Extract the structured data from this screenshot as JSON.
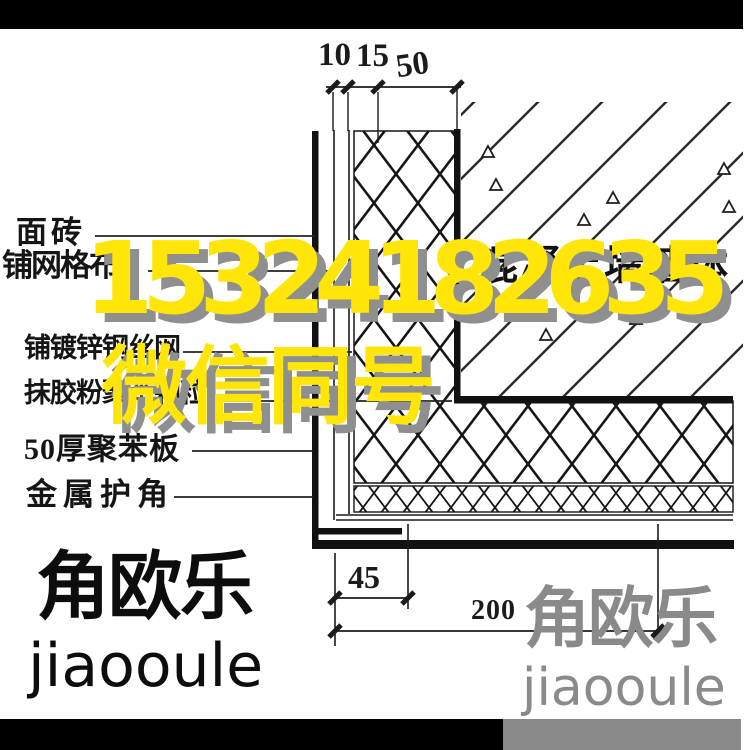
{
  "watermark": {
    "phone": "15324182635",
    "note": "微信同号",
    "color": "#ffe608",
    "shadow_color": "#8f8f8f"
  },
  "drawing": {
    "left_labels": [
      "面砖",
      "铺网格布",
      "铺镀锌钢丝网",
      "抹胶粉聚苯颗粒",
      "50厚聚苯板",
      "金属护角"
    ],
    "wall_label": "混凝土墙墙体",
    "dim_top": [
      "10",
      "15",
      "50"
    ],
    "dim_bottom": [
      "45",
      "200"
    ]
  },
  "logo": {
    "cn": "角欧乐",
    "en": "jiaooule"
  },
  "colors": {
    "line_black": "#161616",
    "logo_gray": "#8a8a8a",
    "frame_black": "#000000"
  }
}
